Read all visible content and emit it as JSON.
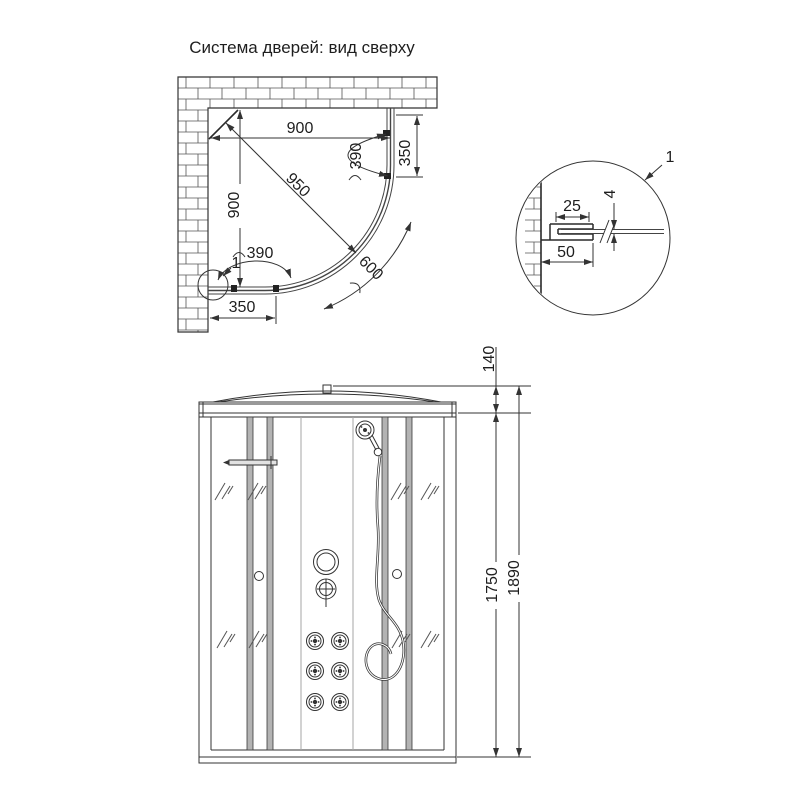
{
  "title": "Система дверей: вид сверху",
  "top_view": {
    "dim_width": "900",
    "dim_height": "900",
    "dim_diagonal": "950",
    "dim_door_right_arc": "390",
    "dim_side_right": "350",
    "dim_door_bottom_arc": "390",
    "dim_door_arc": "600",
    "dim_side_bottom": "350",
    "callout_label": "1"
  },
  "detail_view": {
    "callout_label": "1",
    "dim_profile_width": "25",
    "dim_glass_thickness": "4",
    "dim_wall_offset": "50"
  },
  "front_view": {
    "dim_roof_height": "140",
    "dim_body_height": "1750",
    "dim_total_height": "1890"
  },
  "colors": {
    "line": "#333333",
    "strut_fill": "#b3b3b3",
    "glass_line": "#555555"
  }
}
